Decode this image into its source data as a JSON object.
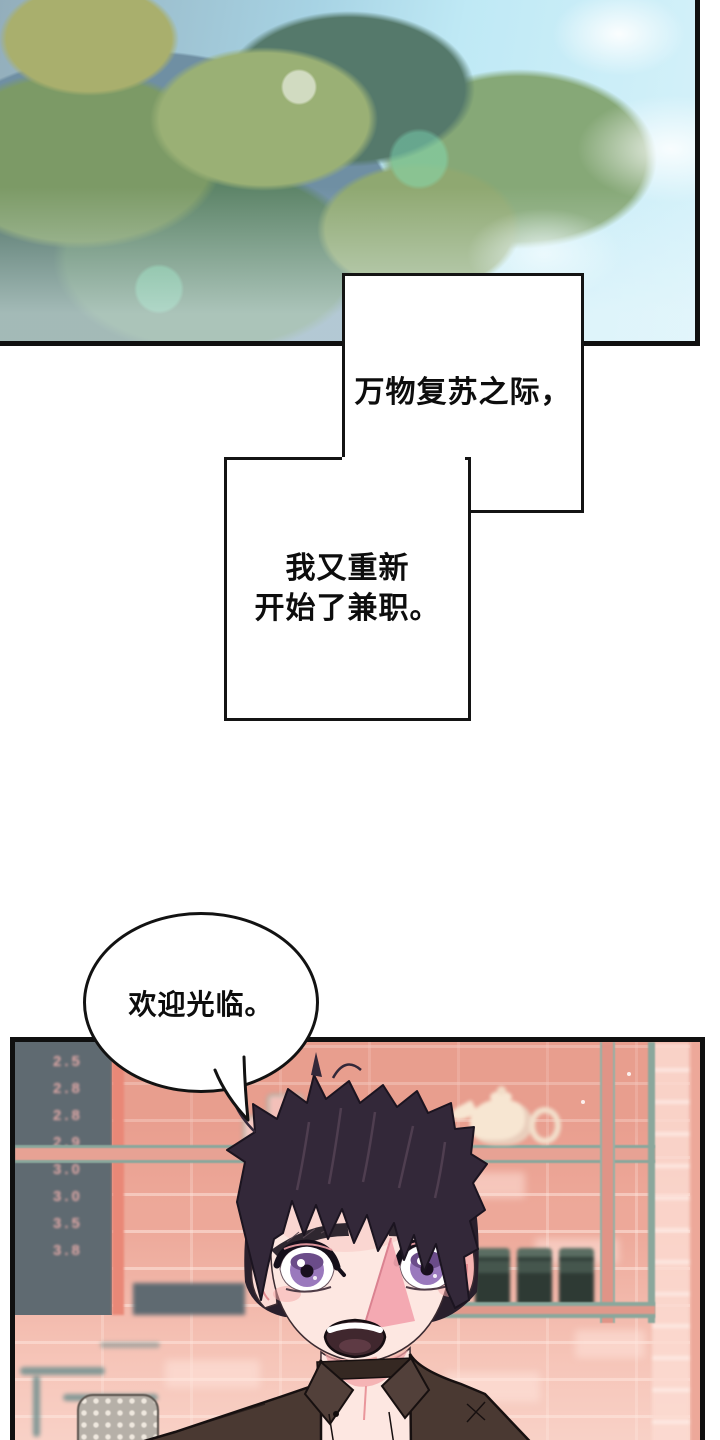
{
  "narration": {
    "box1_text": "万物复苏之际，",
    "box2_line1": "我又重新",
    "box2_line2": "开始了兼职。"
  },
  "speech_bubble": {
    "text": "欢迎光临。"
  },
  "price_board": {
    "values": [
      "2.5",
      "2.8",
      "2.8",
      "2.9",
      "3.0",
      "3.0",
      "3.5",
      "3.8"
    ]
  },
  "colors": {
    "panel_border": "#101010",
    "wall_salmon": "#eda899",
    "brick_light": "#f6d3c7",
    "price_board_bg": "#5f6a71",
    "price_text": "#e0a8a6",
    "shelf_teal": "#8aa79c",
    "sky_blue": "#bfe9f5",
    "foliage_green": "#6d9770",
    "hair": "#332839",
    "skin": "#fde7e1",
    "iris_purple": "#9a79bd",
    "shirt_brown": "#4a3932"
  }
}
